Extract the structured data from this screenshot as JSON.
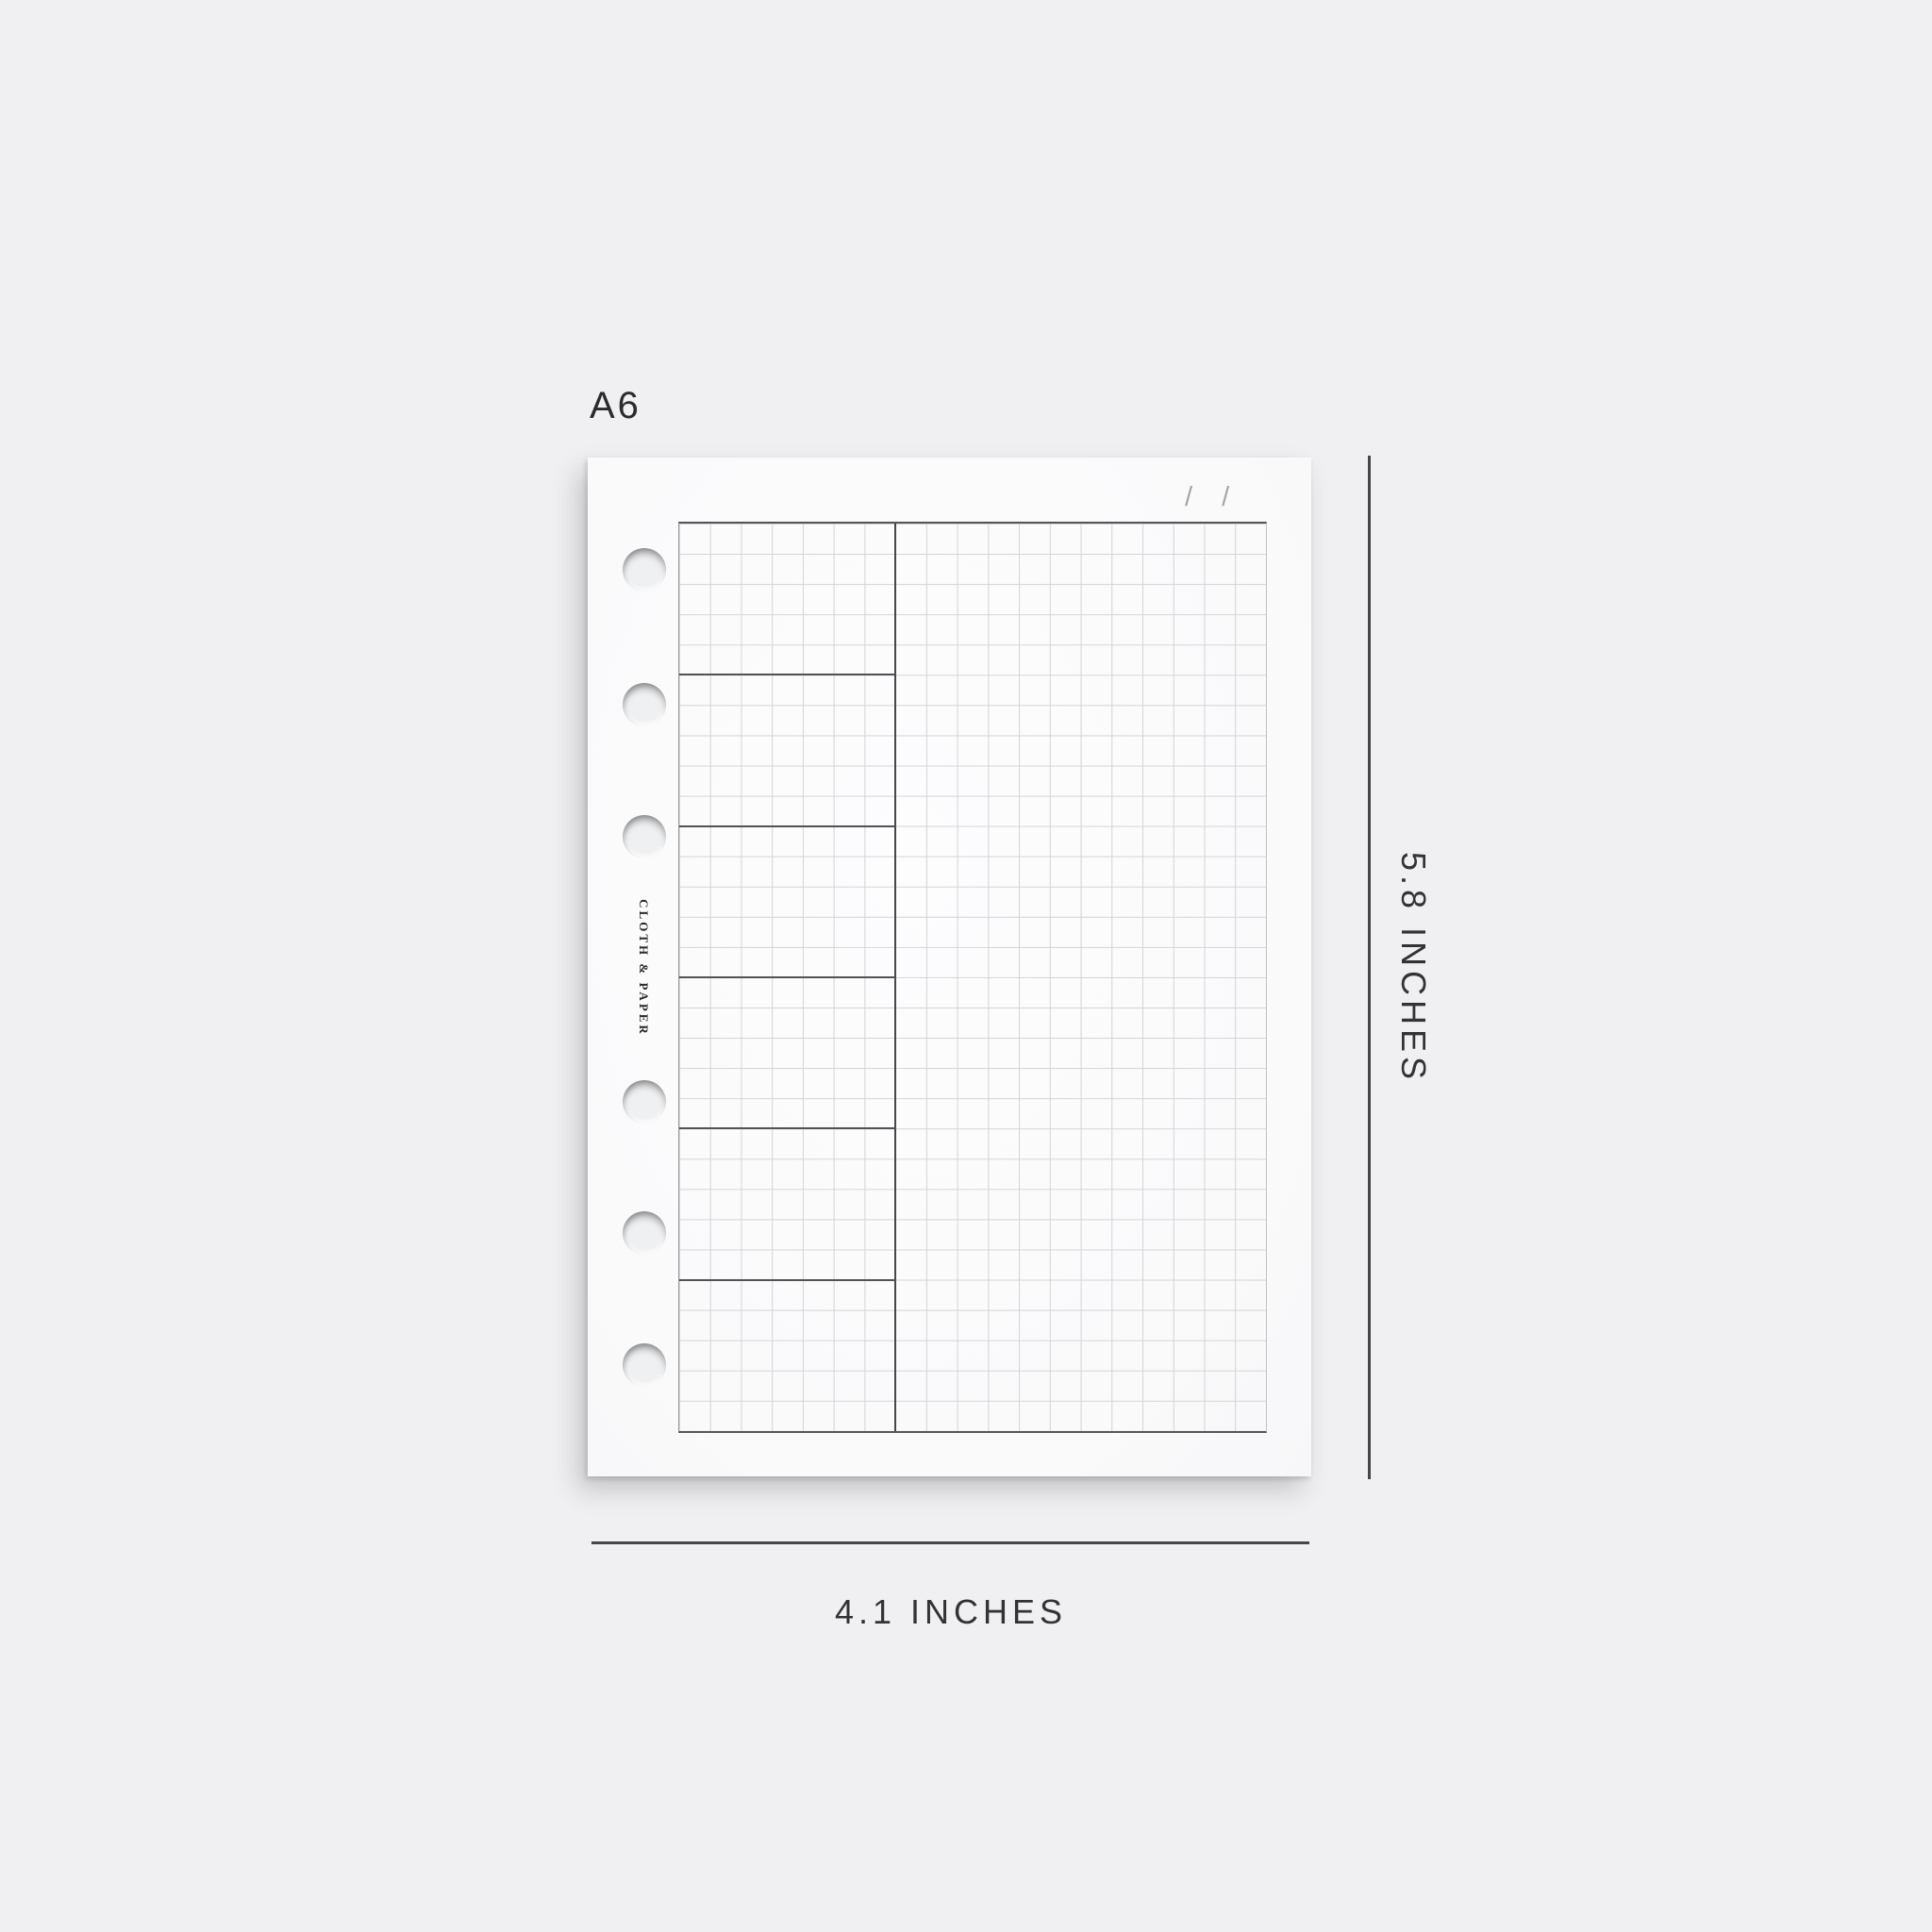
{
  "labels": {
    "size": "A6",
    "width": "4.1 INCHES",
    "height": "5.8 INCHES"
  },
  "brand": {
    "name": "CLOTH & PAPER"
  },
  "page": {
    "date_slashes": [
      "/",
      "/"
    ],
    "grid": {
      "columns": 19,
      "rows": 30,
      "left_column_width_cells": 7,
      "left_section_count": 6,
      "binder_hole_count": 6
    }
  },
  "colors": {
    "background": "#f0f0f2",
    "page": "#fbfbfc",
    "grid_minor_line": "#d3d3d7",
    "grid_border": "#56565a",
    "grid_divider": "#48484c",
    "section_line": "#525256",
    "dimension_line": "#47474a",
    "dimension_text": "#333336",
    "label_text": "#2b2b2d",
    "date_slash": "#a6a6aa"
  }
}
